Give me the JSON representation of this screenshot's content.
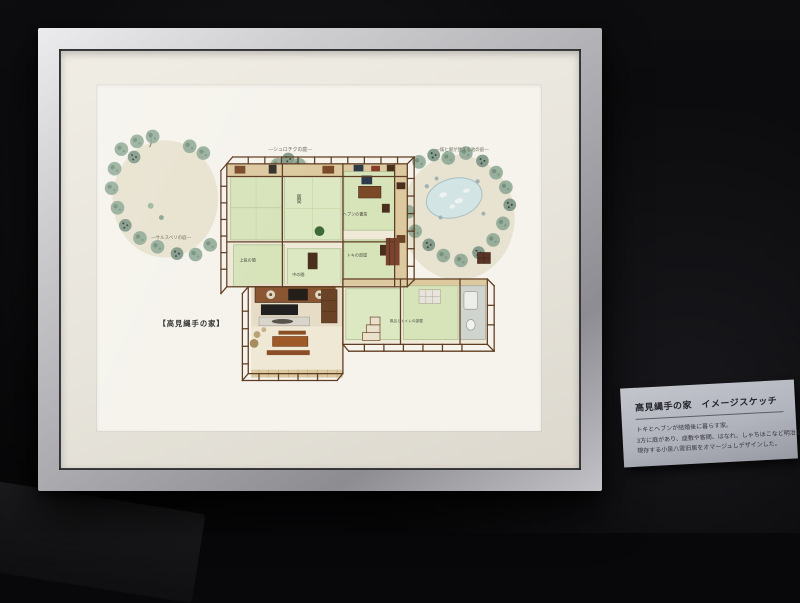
{
  "artwork": {
    "title": "【高見縄手の家】",
    "gardens": {
      "top": "―シュロチクの庭―",
      "left": "―サルスベリの庭―",
      "right": "―城と堀が見える池の庭―"
    },
    "rooms": {
      "living": "居間",
      "study": "ヘブンの書斎",
      "toki": "トキの部屋",
      "upper": "上段の間",
      "middle": "中の間",
      "bath": "風呂とトイレの部屋"
    }
  },
  "card": {
    "title": "高見縄手の家　イメージスケッチ",
    "lines": [
      "トキとヘブンが結婚後に暮らす家。",
      "3方に庭があり、座敷や客間、はなれ、しゃちほこなど明治に",
      "現存する小泉八雲旧居をオマージュしデザインした。"
    ]
  },
  "colors": {
    "wall": "#0a0a0c",
    "frame_metal": "#c9c9cb",
    "mat": "#e9e6de",
    "paper": "#f5f3ec",
    "tatami": "#d7e4ba",
    "wood": "#5f3d22",
    "foliage": "#8aa592",
    "sand": "#e7e0cd",
    "pond": "#d3e4e4",
    "card_bg": "#b4b6bf"
  }
}
